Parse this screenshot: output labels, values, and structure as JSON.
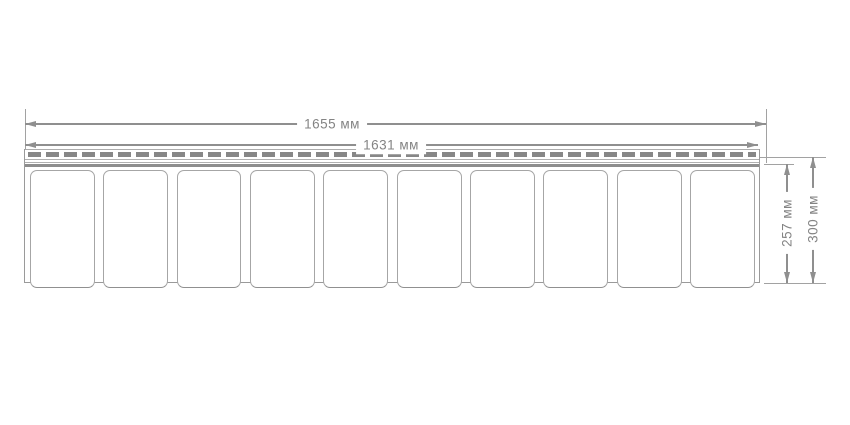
{
  "diagram": {
    "type": "technical-drawing",
    "subject": "siding-panel-front-view",
    "dimensions": {
      "total_width_label": "1655 мм",
      "working_width_label": "1631 мм",
      "panel_height_label": "257 мм",
      "total_height_label": "300 мм"
    },
    "panels": {
      "count": 10
    },
    "nail_strip": {
      "slot_pattern": "dashed-perforation"
    },
    "colors": {
      "line": "#8f8f8f",
      "text": "#848484",
      "panel_border": "#a6a6a6",
      "slot": "#878787",
      "background": "#ffffff"
    }
  }
}
